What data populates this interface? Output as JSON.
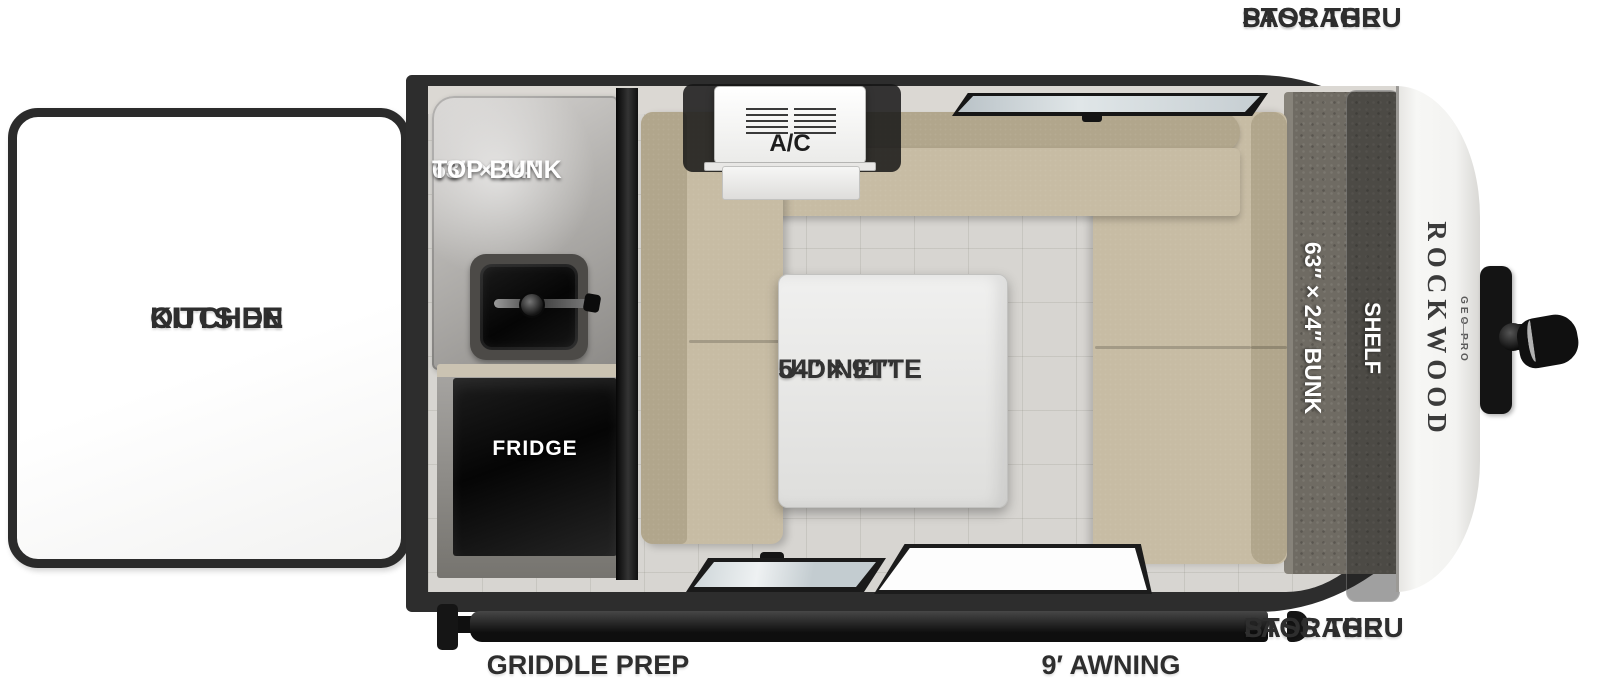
{
  "colors": {
    "body_dark": "#2d2d2d",
    "floor": "#d7d5d1",
    "cushion_seat": "#c7bca4",
    "cushion_back": "#b1a68c",
    "carpet": "#6f6b63",
    "cap_white": "#f5f5f3",
    "label_dark": "#2e2e2e"
  },
  "exterior": {
    "pass_thru_top": {
      "line1": "PASS THRU",
      "line2": "STORAGE"
    },
    "pass_thru_bottom": {
      "line1": "PASS THRU",
      "line2": "STORAGE"
    },
    "outside_kitchen": {
      "line1": "OUTSIDE",
      "line2": "KITCHEN"
    },
    "griddle_prep": "GRIDDLE PREP",
    "awning": "9′ AWNING"
  },
  "interior": {
    "top_bunk": {
      "line1": "63″ × 24″",
      "line2": "TOP BUNK"
    },
    "fridge": "FRIDGE",
    "ac": "A/C",
    "dinette": {
      "line1": "54″ × 91″",
      "line2": "U-DINETTE"
    },
    "bunk": "63″ × 24″ BUNK",
    "shelf": "SHELF"
  },
  "brand": {
    "name": "ROCKWOOD",
    "sub": "GEO PRO"
  }
}
